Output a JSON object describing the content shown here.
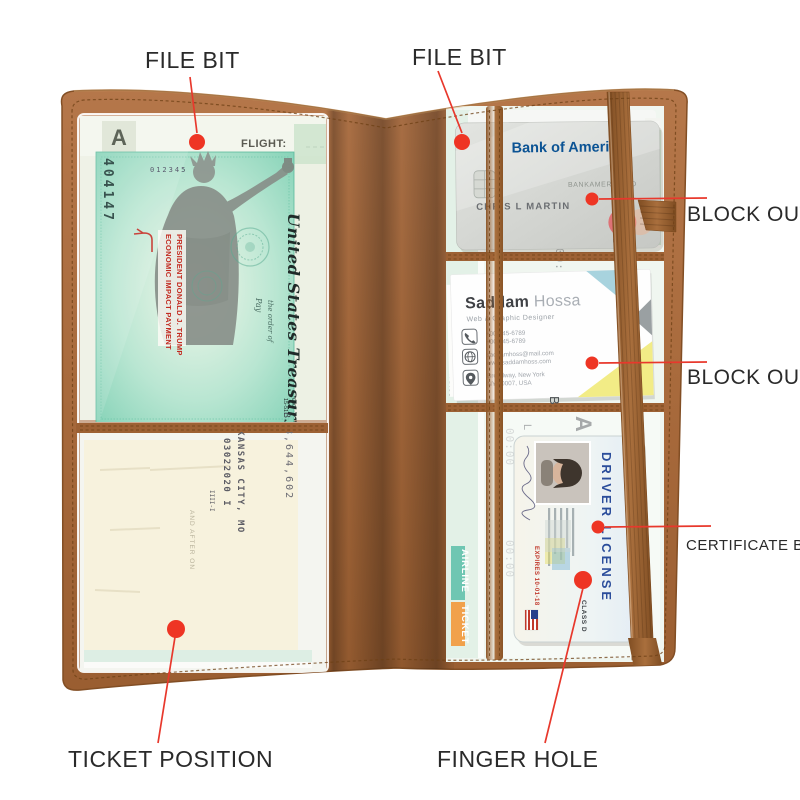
{
  "colors": {
    "accent_red": "#ee3524",
    "leather": "#a2663a",
    "leather_dark": "#7c4a1f",
    "check_green": "#86d6bd",
    "bank_blue": "#0b5394",
    "ticket_mint": "#dff0e6",
    "ticket_orange": "#f1a14b",
    "ticket_teal": "#6fc6b2"
  },
  "annotations": {
    "file_bit_left": "FILE BIT",
    "file_bit_right": "FILE BIT",
    "block_out_top": "BLOCK OUT",
    "block_out_bottom": "BLOCK OUT",
    "certificate_bit": "CERTIFICATE BIT",
    "ticket_position": "TICKET POSITION",
    "finger_hole": "FINGER HOLE"
  },
  "left_panel": {
    "boarding_pass": {
      "flight_label": "FLIGHT:",
      "gate_letter": "A"
    },
    "treasury_check": {
      "serial": "012345",
      "micr": "404147",
      "issuer": "United States Treasury",
      "fraction": "15-51",
      "fraction2": "000",
      "stamp_line1": "ECONOMIC IMPACT PAYMENT",
      "stamp_line2": "PRESIDENT DONALD J. TRUMP",
      "pay_label": "Pay",
      "order_label": "the order of",
      "fragment_b": "B"
    },
    "check_back": {
      "city_line": "KANSAS CITY, MO",
      "date_line": "03022020 I",
      "amount_line": "8,644,602",
      "micr_marks": "IIII-I",
      "faint_line": "AND AFTER ON"
    }
  },
  "right_panel": {
    "bank_card": {
      "bank_name": "Bank of America",
      "product_name": "BANKAMERICARD",
      "holder_name": "CHRIS L MARTIN",
      "network_letter": "m"
    },
    "business_card": {
      "first_name": "Saddam",
      "last_name": " Hossa",
      "job_title": "Web & Graphic Designer",
      "phone1": "+00-345-6789",
      "phone2": "+00-345-6789",
      "email": "saddamhoss@mail.com",
      "website": "www.saddamhoss.com",
      "address1": "Broadway, New York",
      "address2": "NY 10007, USA"
    },
    "driver_license": {
      "doc_title": "DRIVER LICENSE",
      "state_name": "NEW YORK STATE",
      "class_line": "CLASS D",
      "expires_line": "EXPIRES 10-01-18"
    },
    "ticket": {
      "label_airline": "AIRLINE",
      "label_ticket": "TICKET",
      "time1": "00:00",
      "time2": "00:00",
      "time3": "00:00",
      "no_label": "NO.00",
      "letter_b": "B",
      "letter_a": "A",
      "letter_l": "L"
    }
  }
}
